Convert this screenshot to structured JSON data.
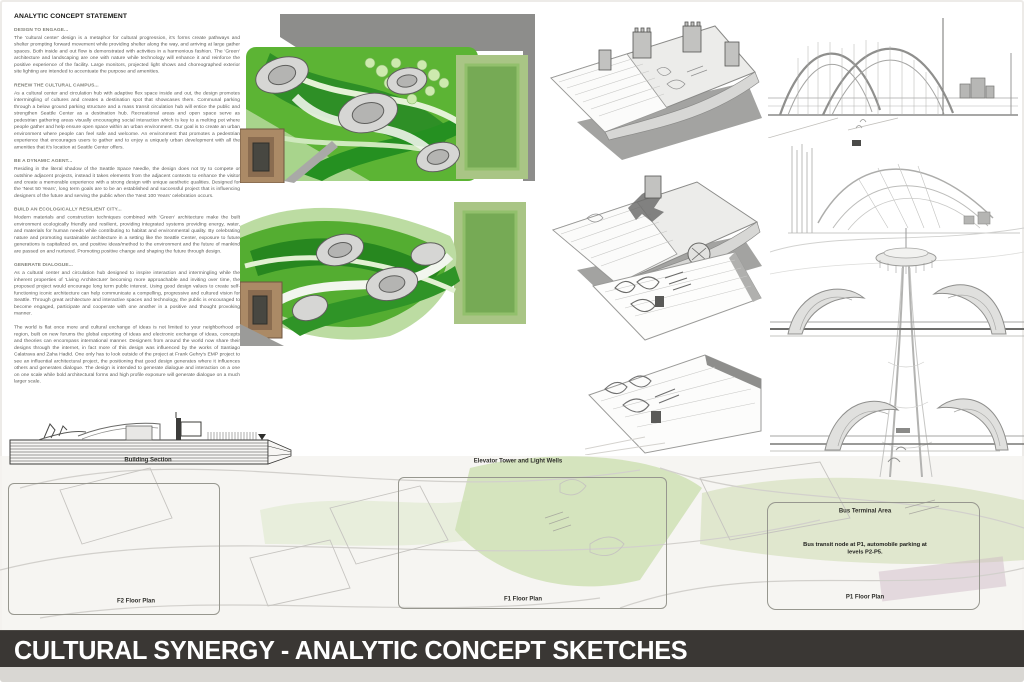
{
  "board": {
    "title_bar": "CULTURAL SYNERGY - ANALYTIC CONCEPT SKETCHES"
  },
  "statement": {
    "title": "ANALYTIC CONCEPT STATEMENT",
    "sections": [
      {
        "heading": "DESIGN TO ENGAGE...",
        "body": "The 'cultural center' design is a metaphor for cultural progression, it's forms create pathways and shelter prompting forward movement while providing shelter along the way, and arriving at large gather spaces. Both inside and out flow is demonstrated with activities in a harmonious fashion. The 'Green' architecture and landscaping are one with nature while technology will enhance it and reinforce the positive experience of the facility. Large monitors, projected light shows and choreographed exterior site lighting are intended to accentuate the purpose and amenities."
      },
      {
        "heading": "RENEW THE CULTURAL CAMPUS...",
        "body": "As a cultural center and circulation hub with adaptive flex space inside and out, the design promotes intermingling of cultures and creates a destination spot that showcases them. Communal parking through a below ground parking structure and a mass transit circulation hub will entice the public and strengthen Seattle Center as a destination hub. Recreational areas and open space serve as pedestrian gathering areas visually encouraging social interaction which is key to a melting pot where people gather and help ensure open space within an urban environment. Our goal is to create an urban environment where people can feel safe and welcome. An environment that promotes a pedestrian experience that encourages users to gather and to enjoy a uniquely urban development with all the amenities that it's location at Seattle Center offers."
      },
      {
        "heading": "BE A DYNAMIC AGENT...",
        "body": "Residing in the literal shadow of the Seattle Space Needle, the design does not try to compete or outshine adjacent projects, instead it takes elements from the adjacent contexts to enhance the visitor and create a memorable experience with a strong design with unique aesthetic qualities. Designed for the 'Next 50 Years', long term goals are to be an established and successful project that is influencing designers of the future and serving the public when the 'Next 100 Years' celebration occurs."
      },
      {
        "heading": "BUILD AN ECOLOGICALLY RESILIENT CITY...",
        "body": "Modern materials and construction techniques combined with 'Green' architecture make the built environment ecologically friendly and resilient, providing integrated systems providing energy, water, and materials for human needs while contributing to habitat and environmental quality. By celebrating nature and promoting sustainable architecture in a setting like the Seattle Center, exposure to future generations is capitalized on, and positive ideas/method to the environment and the future of mankind are passed on and nurtured. Promoting positive change and shaping the future through design."
      },
      {
        "heading": "GENERATE DIALOGUE...",
        "body": "As a cultural center and circulation hub designed to inspire interaction and intermingling while the inherent properties of 'Living Architecture' becoming more approachable and inviting over time, the proposed project would encourage long term public interest. Using good design values to create self-functioning iconic architecture can help communicate a compelling, progressive and cultured vision for Seattle. Through great architecture and interactive spaces and technology, the public is encouraged to become engaged, participate and cooperate with one another in a positive and thought provoking manner."
      }
    ],
    "closing": "The world is flat once more and cultural exchange of ideas is not limited to your neighborhood or region, built on new forums the global exporting of ideas and electronic exchange of ideas, concepts and theories can encompass international manner. Designers from around the world now share their designs through the internet, in fact more of this design was influenced by the works of Santiago Calatrava and Zaha Hadid. One only has to look outside of the project at Frank Gehry's EMP project to see an influential architectural project, the positioning that good design generates where it influences others and generates dialogue. The design is intended to generate dialogue and interaction on a one on one scale while bold architectural forms and high profile exposure will generate dialogue on a much larger scale."
  },
  "labels": {
    "building_section": "Building Section",
    "elevator_tower": "Elevator Tower and Light Wells",
    "f2_floor_plan": "F2 Floor Plan",
    "f1_floor_plan": "F1 Floor Plan",
    "p1_floor_plan": "P1 Floor Plan",
    "bus_terminal_area": "Bus Terminal Area",
    "bus_note": "Bus transit node at P1, automobile parking at levels P2-P5."
  },
  "colors": {
    "title_bar_bg": "#3a3734",
    "title_bar_fg": "#ffffff",
    "landscape_green": "#54ad31",
    "dark_green": "#27871f",
    "field_green": "#a9c585",
    "context_gray": "#8d8d8b",
    "sketch_gray": "#a8a8a6"
  }
}
